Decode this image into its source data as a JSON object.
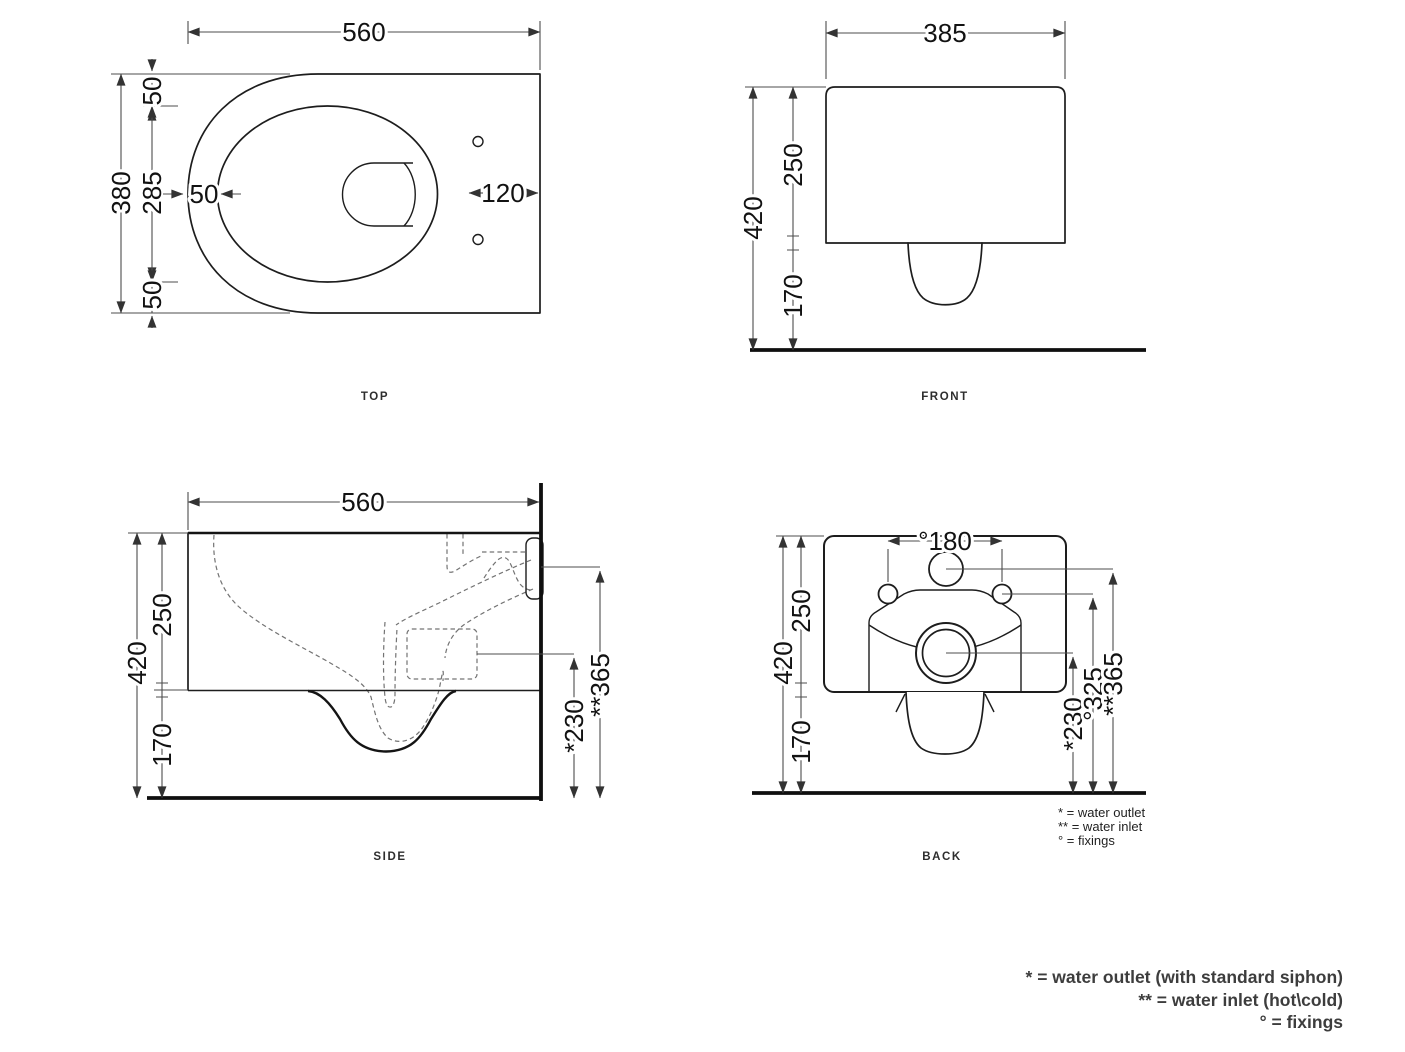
{
  "views": {
    "top": {
      "label": "TOP",
      "dims": {
        "width": "560",
        "depth": "380",
        "inner_depth": "285",
        "gap_front": "50",
        "gap_back": "50",
        "rim_offset": "50",
        "holes": "120"
      }
    },
    "front": {
      "label": "FRONT",
      "dims": {
        "width": "385",
        "height": "420",
        "body": "250",
        "clearance": "170"
      }
    },
    "side": {
      "label": "SIDE",
      "dims": {
        "depth": "560",
        "height": "420",
        "body": "250",
        "clearance": "170",
        "outlet": "*230",
        "inlet": "**365"
      }
    },
    "back": {
      "label": "BACK",
      "dims": {
        "height": "420",
        "body": "250",
        "clearance": "170",
        "fixings_span": "°180",
        "outlet": "*230",
        "fixings_height": "°325",
        "inlet": "**365"
      },
      "legend": [
        "* = water outlet",
        "** = water inlet",
        "° = fixings"
      ]
    }
  },
  "footnotes": [
    "* = water outlet (with standard siphon)",
    "** = water inlet (hot\\cold)",
    "° = fixings"
  ]
}
